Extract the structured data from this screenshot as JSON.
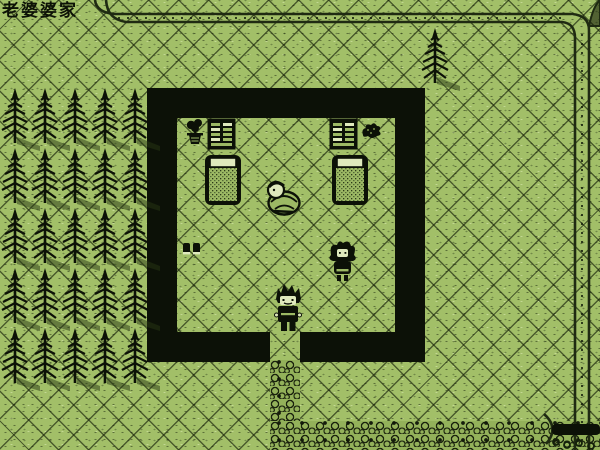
{
  "header": {
    "title": "老婆婆家"
  },
  "palette": {
    "grass": "#a2bf68",
    "outline_black": "#0c1107",
    "shadow_olive": "#3d5022",
    "river_line": "#1f2a12",
    "cobble_base": "#93b15a",
    "highlight_white": "#dfe9bd"
  },
  "scene": {
    "room": {
      "x": 147,
      "y": 88,
      "w": 278,
      "h": 274,
      "wall_thickness": 30,
      "door": {
        "x": 270,
        "w": 30
      }
    },
    "forest": {
      "columns": [
        0,
        30,
        60,
        90,
        120
      ],
      "rows": [
        88,
        148,
        208,
        268,
        328
      ]
    },
    "lone_tree": {
      "x": 420,
      "y": 28
    },
    "walkway": {
      "x": 270,
      "y": 360,
      "w": 30,
      "h": 90
    },
    "road": {
      "x": 270,
      "y": 421,
      "w": 330,
      "h": 29
    },
    "entities": [
      {
        "id": "bonsai-plant",
        "sprite": "bonsai",
        "x": 184,
        "y": 118,
        "interactable": true
      },
      {
        "id": "bookshelf-left",
        "sprite": "shelf",
        "x": 207,
        "y": 118,
        "interactable": true
      },
      {
        "id": "bookshelf-right",
        "sprite": "shelf",
        "x": 329,
        "y": 118,
        "interactable": true
      },
      {
        "id": "dark-shrub",
        "sprite": "bush",
        "x": 360,
        "y": 121,
        "interactable": false
      },
      {
        "id": "bed-left",
        "sprite": "bed",
        "x": 204,
        "y": 154,
        "interactable": true
      },
      {
        "id": "bed-right",
        "sprite": "bed",
        "x": 331,
        "y": 154,
        "interactable": true
      },
      {
        "id": "granny-npc",
        "sprite": "granny",
        "x": 261,
        "y": 178,
        "interactable": true
      },
      {
        "id": "shoes-item",
        "sprite": "shoes",
        "x": 182,
        "y": 241,
        "interactable": true
      },
      {
        "id": "girl-npc",
        "sprite": "girl",
        "x": 327,
        "y": 239,
        "interactable": true
      },
      {
        "id": "player-character",
        "sprite": "player",
        "x": 271,
        "y": 282,
        "interactable": true
      }
    ]
  }
}
